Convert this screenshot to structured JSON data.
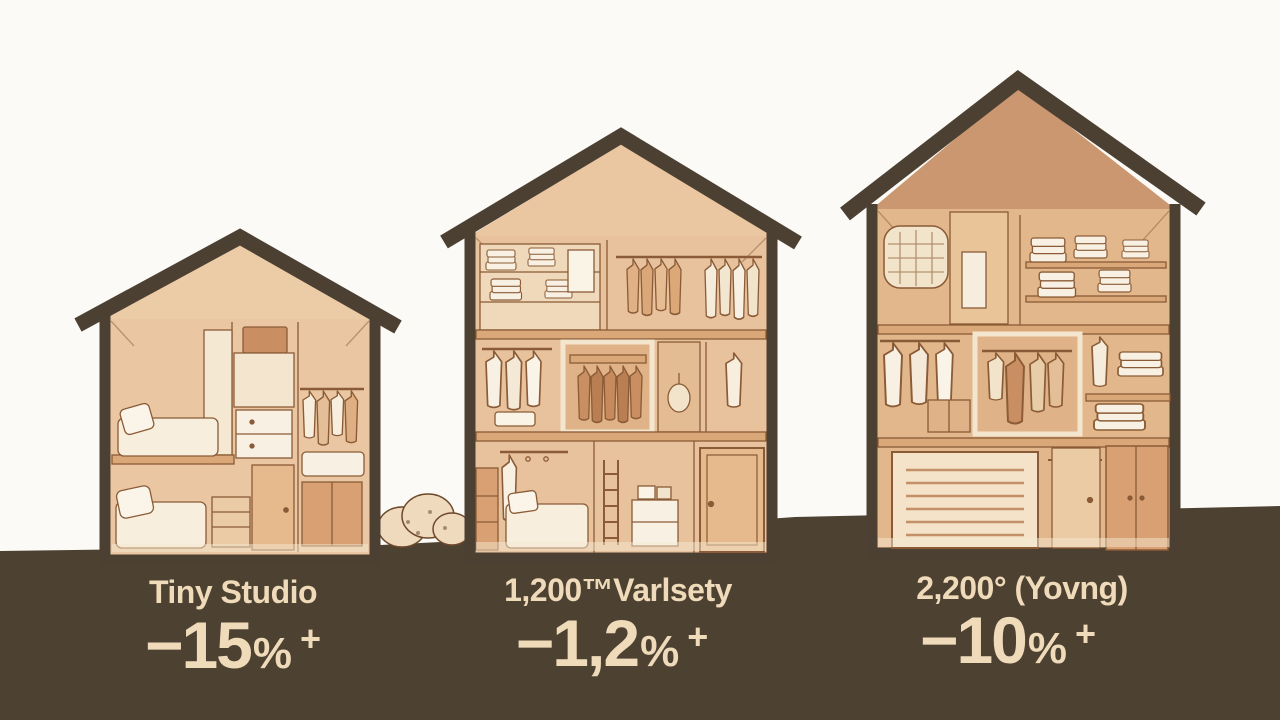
{
  "scene": {
    "background_color": "#FBFAF6",
    "ground_color": "#4D4132",
    "outline_color": "#4C4033",
    "ink_color": "#8A5B36",
    "text_color": "#EFDAB9",
    "house_fill_light": "#EAC7A2",
    "house_fill_dark": "#CB9770"
  },
  "houses": [
    {
      "id": "tiny-studio",
      "label": "Tiny Studio",
      "value_number": "−15",
      "value_percent": "%",
      "value_plus": "+"
    },
    {
      "id": "medium-house",
      "label": "1,200™Varlsety",
      "value_number": "−1,2",
      "value_percent": "%",
      "value_plus": "+"
    },
    {
      "id": "large-house",
      "label": "2,200° (Yovng)",
      "value_number": "−10",
      "value_percent": "%",
      "value_plus": "+"
    }
  ]
}
